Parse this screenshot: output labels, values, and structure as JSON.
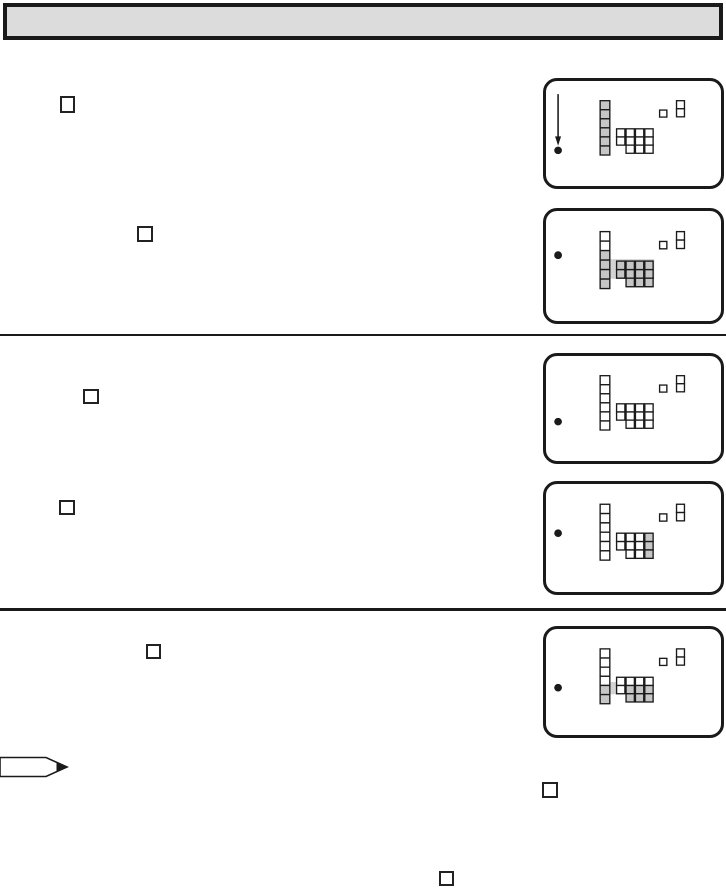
{
  "page": {
    "kind": "scanned-manual-page",
    "visible_text": "",
    "background_color": "#ffffff"
  },
  "header": {
    "title": "",
    "fill_color": "#dcdcdc",
    "border_color": "#1a1a1a"
  },
  "colors": {
    "ink": "#1a1a1a",
    "highlight": "#c6c6c6",
    "band": "#d4d4d4",
    "white": "#ffffff"
  },
  "step_boxes": [
    {
      "id": "step-box-1",
      "label": ""
    },
    {
      "id": "step-box-2",
      "label": ""
    },
    {
      "id": "step-box-3",
      "label": ""
    },
    {
      "id": "step-box-4",
      "label": ""
    },
    {
      "id": "step-box-5",
      "label": ""
    },
    {
      "id": "step-box-6",
      "label": ""
    },
    {
      "id": "step-box-7",
      "label": ""
    }
  ],
  "figures": {
    "description": "Five rounded-corner panels depicting a miniature on-screen display: a pointer bullet (panel 1 also has a downward arrow), a tall 6-cell menu column, a cluster of small cell columns (one 2-cell, three 3-cell), and a small square plus 2-cell stack icon at top right. 'g' = gray highlighted cell, 'w' = white cell.",
    "screens": [
      {
        "id": "screen-1",
        "pointer": "arrow-bullet",
        "bullet_y": 74,
        "band": null,
        "menu_column": [
          "g",
          "g",
          "g",
          "g",
          "g",
          "g"
        ],
        "left_pair": [
          "w",
          "w"
        ],
        "triples": [
          [
            "w",
            "w",
            "w"
          ],
          [
            "w",
            "w",
            "w"
          ],
          [
            "w",
            "w",
            "w"
          ]
        ]
      },
      {
        "id": "screen-2",
        "pointer": "bullet",
        "bullet_y": 45,
        "band": {
          "x": 56,
          "y": 49,
          "w": 56,
          "h": 20
        },
        "menu_column": [
          "w",
          "w",
          "g",
          "g",
          "g",
          "g"
        ],
        "left_pair": [
          "g",
          "g"
        ],
        "triples": [
          [
            "g",
            "g",
            "g"
          ],
          [
            "g",
            "g",
            "g"
          ],
          [
            "g",
            "g",
            "g"
          ]
        ]
      },
      {
        "id": "screen-3",
        "pointer": "bullet",
        "bullet_y": 70,
        "band": null,
        "menu_column": [
          "w",
          "w",
          "w",
          "w",
          "w",
          "w"
        ],
        "left_pair": [
          "w",
          "w"
        ],
        "triples": [
          [
            "w",
            "w",
            "w"
          ],
          [
            "w",
            "w",
            "w"
          ],
          [
            "w",
            "w",
            "w"
          ]
        ]
      },
      {
        "id": "screen-4",
        "pointer": "bullet",
        "bullet_y": 51,
        "band": null,
        "menu_column": [
          "w",
          "w",
          "w",
          "w",
          "w",
          "w"
        ],
        "left_pair": [
          "w",
          "w"
        ],
        "triples": [
          [
            "w",
            "w",
            "w"
          ],
          [
            "w",
            "w",
            "w"
          ],
          [
            "g",
            "g",
            "g"
          ]
        ]
      },
      {
        "id": "screen-5",
        "pointer": "bullet",
        "bullet_y": 62,
        "band": {
          "x": 56,
          "y": 56,
          "w": 23,
          "h": 13
        },
        "menu_column": [
          "w",
          "w",
          "w",
          "w",
          "g",
          "g"
        ],
        "left_pair": [
          "w",
          "w"
        ],
        "triples": [
          [
            "w",
            "g",
            "g"
          ],
          [
            "w",
            "g",
            "g"
          ],
          [
            "w",
            "g",
            "g"
          ]
        ]
      }
    ]
  }
}
